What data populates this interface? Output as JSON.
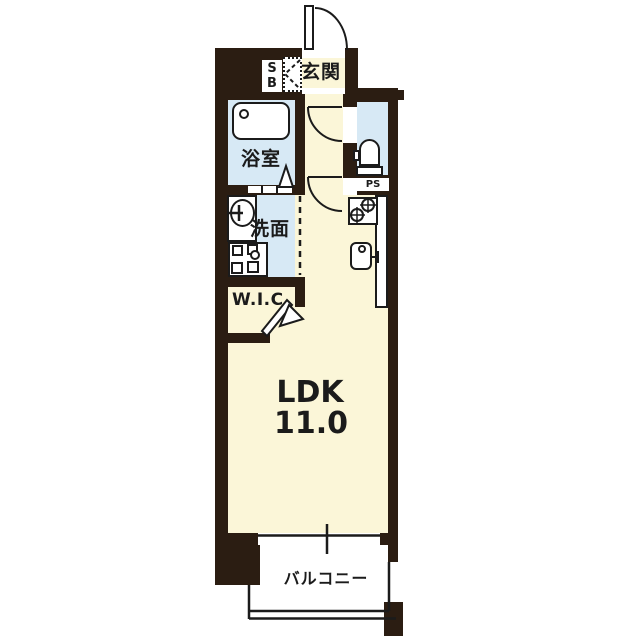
{
  "floorplan": {
    "type": "apartment-floor-plan",
    "rooms": {
      "genkan": "玄関",
      "shoebox": "SB",
      "bathroom": "浴室",
      "washroom": "洗面",
      "wic": "W.I.C",
      "pipe_space": "PS",
      "ldk_label": "LDK",
      "ldk_size": "11.0",
      "balcony": "バルコニー"
    },
    "colors": {
      "wall": "#2b1d12",
      "room_floor": "#fbf6d8",
      "wet_area_floor": "#d7e9f5",
      "linework": "#1b1b1b",
      "background": "#ffffff"
    }
  }
}
